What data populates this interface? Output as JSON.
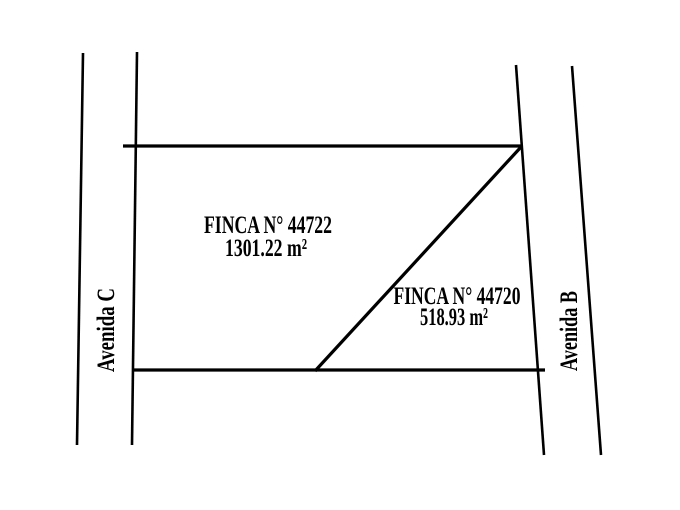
{
  "page": {
    "background_color": "#ffffff"
  },
  "diagram": {
    "type": "cadastral-parcel-plan",
    "line_color": "#000000",
    "text_color": "#000000",
    "parcels": [
      {
        "name": "FINCA N° 44722",
        "area": "1301.22 m²"
      },
      {
        "name": "FINCA N° 44720",
        "area": "518.93 m²"
      }
    ],
    "streets": {
      "left": {
        "name": "Avenida C"
      },
      "right": {
        "name": "Avenida B"
      }
    }
  }
}
